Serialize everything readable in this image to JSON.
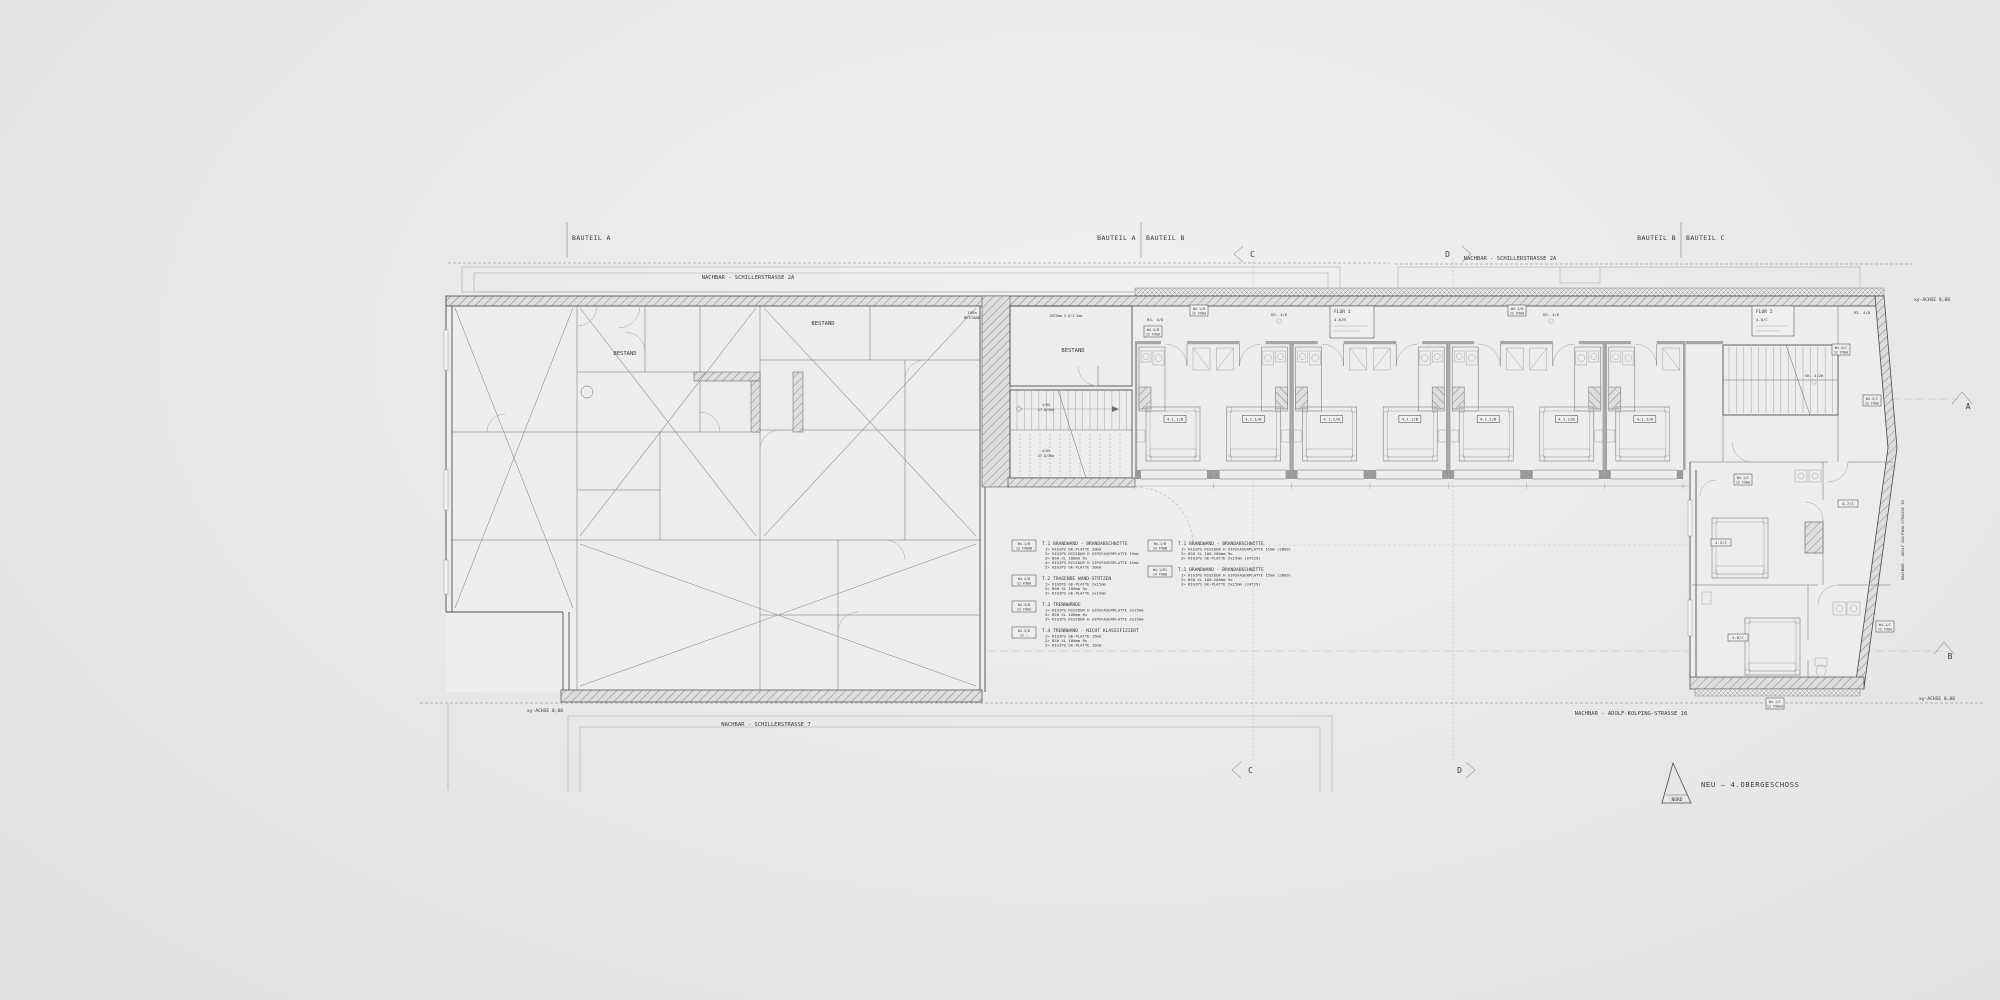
{
  "sheet": {
    "title": "NEU – 4.OBERGESCHOSS",
    "north": "NORD"
  },
  "bauteil": {
    "a": "BAUTEIL A",
    "b": "BAUTEIL B",
    "c": "BAUTEIL C"
  },
  "neighbors": {
    "top": "NACHBAR - SCHILLERSTRASSE 2A",
    "bottom_left": "NACHBAR - SCHILLERSTRASSE 7",
    "bottom_right": "NACHBAR - ADOLF-KOLPING-STRASSE 16",
    "right_side": "NACHBAR - ADOLF-KOLPING-STRASSE 16"
  },
  "axes": {
    "xy": "xy-ACHSE 0,00",
    "a": "A",
    "b": "B",
    "c": "C",
    "d": "D"
  },
  "rooms": {
    "bestand": "BESTAND",
    "attic": "195a",
    "flur1": "FLUR 1",
    "flur1_no": "4.8/B",
    "flur2": "FLUR 2",
    "flur2_no": "4.6/C",
    "unit_tag": "4.1.1/B",
    "c_room1": "4.5/C",
    "c_room2": "4.6/C",
    "c_room3": "4.7/C"
  },
  "stairs": {
    "run": "4/05",
    "dim": "17.8/36m",
    "shaft": "SH. 4/20"
  },
  "tags": {
    "r3": "R3. 4/D",
    "sh": "SH. 4/D",
    "w41b": "W4.1/B",
    "w45b": "W4.5/B",
    "w41c": "W4.1/C",
    "w43c": "W4.3/C",
    "w45c": "W4.5/C",
    "f90a": "12 F90A",
    "f90a4": "12 F90A4",
    "window_dim": "DR75mm 5.0/1.2mm"
  },
  "legend": {
    "left": [
      {
        "tag": [
          "W4.1/B",
          "12 F90AB"
        ],
        "title": "T.1 BRANDWAND - BRANDABSCHNITTE",
        "bullets": [
          "1> RIGIPS GK-PLATTE 20mm",
          "2> RIGIPS RIGIDUR H GIPSFASERPLATTE 15mm",
          "3> BSH XL 100mm 9x",
          "4> RIGIPS RIGIDUR H GIPSFASERPLATTE 15mm",
          "5> RIGIPS GK-PLATTE 20mm"
        ]
      },
      {
        "tag": [
          "W4.2/B",
          "12 F90A"
        ],
        "title": "T.2 TRAGENDE WAND-STÜTZEN",
        "bullets": [
          "1> RIGIPS GK-PLATTE 2x15mm",
          "2> BSH XL 100mm 9x",
          "3> RIGIPS GK-PLATTE 2x15mm"
        ]
      },
      {
        "tag": [
          "W4.3/B",
          "12 F90A"
        ],
        "title": "T.3 TRENNWÄNDE",
        "bullets": [
          "1> RIGIPS RIGIDUR H GIPSFASERPLATTE 2x15mm",
          "2> BSH XL 100mm 9x",
          "3> RIGIPS RIGIDUR H GIPSFASERPLATTE 2x15mm"
        ]
      },
      {
        "tag": [
          "W4.5/B",
          "12 —"
        ],
        "title": "T.4 TRENNWAND - NICHT KLASSIFIZIERT",
        "bullets": [
          "1> RIGIPS GK-PLATTE 15mm",
          "2> BSH XL 100mm 9x",
          "3> RIGIPS GK-PLATTE 15mm"
        ]
      }
    ],
    "right": [
      {
        "tag": [
          "W4.1/B",
          "14 F90B"
        ],
        "title": "T.1 BRANDWAND - BRANDABSCHNITTE",
        "bullets": [
          "1> RIGIPS RIGIDUR H GIPSFASERPLATTE 15mm (2B09)",
          "2> BSH XL 100-200mm 9x",
          "3> RIGIPS GK-PLATTE 2x15mm (24T29)"
        ]
      },
      {
        "tag": [
          "W4.1/B1",
          "14 F90B"
        ],
        "title": "T.1 BRANDWAND - BRANDABSCHNITTE",
        "bullets": [
          "1> RIGIPS RIGIDUR H GIPSFASERPLATTE 15mm (2B09)",
          "2> BSH XL 100-200mm 9x",
          "3> RIGIPS GK-PLATTE 2x15mm (24T29)"
        ]
      }
    ]
  }
}
